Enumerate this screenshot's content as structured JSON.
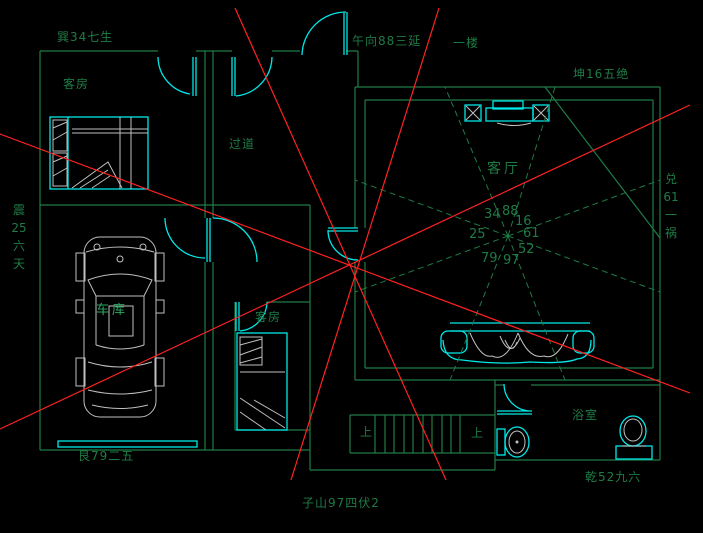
{
  "drawing_type": "feng-shui floor plan (CAD)",
  "colors": {
    "background": "#000000",
    "wall_green": "#1f7b46",
    "bright_label_green": "#2aa862",
    "fixture_cyan": "#00e8e8",
    "analysis_red": "#ff2222",
    "furniture_gray": "#bfbfbf"
  },
  "annotations": {
    "top_left": "巽34七生",
    "top_center": "午向88三延",
    "floor_label": "一楼",
    "top_right": "坤16五绝",
    "left_vertical": [
      "震",
      "25",
      "六",
      "天"
    ],
    "right_vertical": [
      "兑",
      "61",
      "一",
      "祸"
    ],
    "bottom_left": "艮79二五",
    "bottom_right": "乾52九六",
    "bottom_center": "子山97四伏2"
  },
  "rooms": {
    "guest_room_1": "客房",
    "corridor": "过道",
    "living_room": "客厅",
    "garage": "车库",
    "guest_room_2": "客房",
    "bathroom": "浴室",
    "stairs_up_left": "上",
    "stairs_up_right": "上"
  },
  "compass": {
    "nw": "34",
    "n": "88",
    "ne": "16",
    "w": "25",
    "e": "61",
    "sw": "79",
    "s": "97",
    "se": "52"
  }
}
